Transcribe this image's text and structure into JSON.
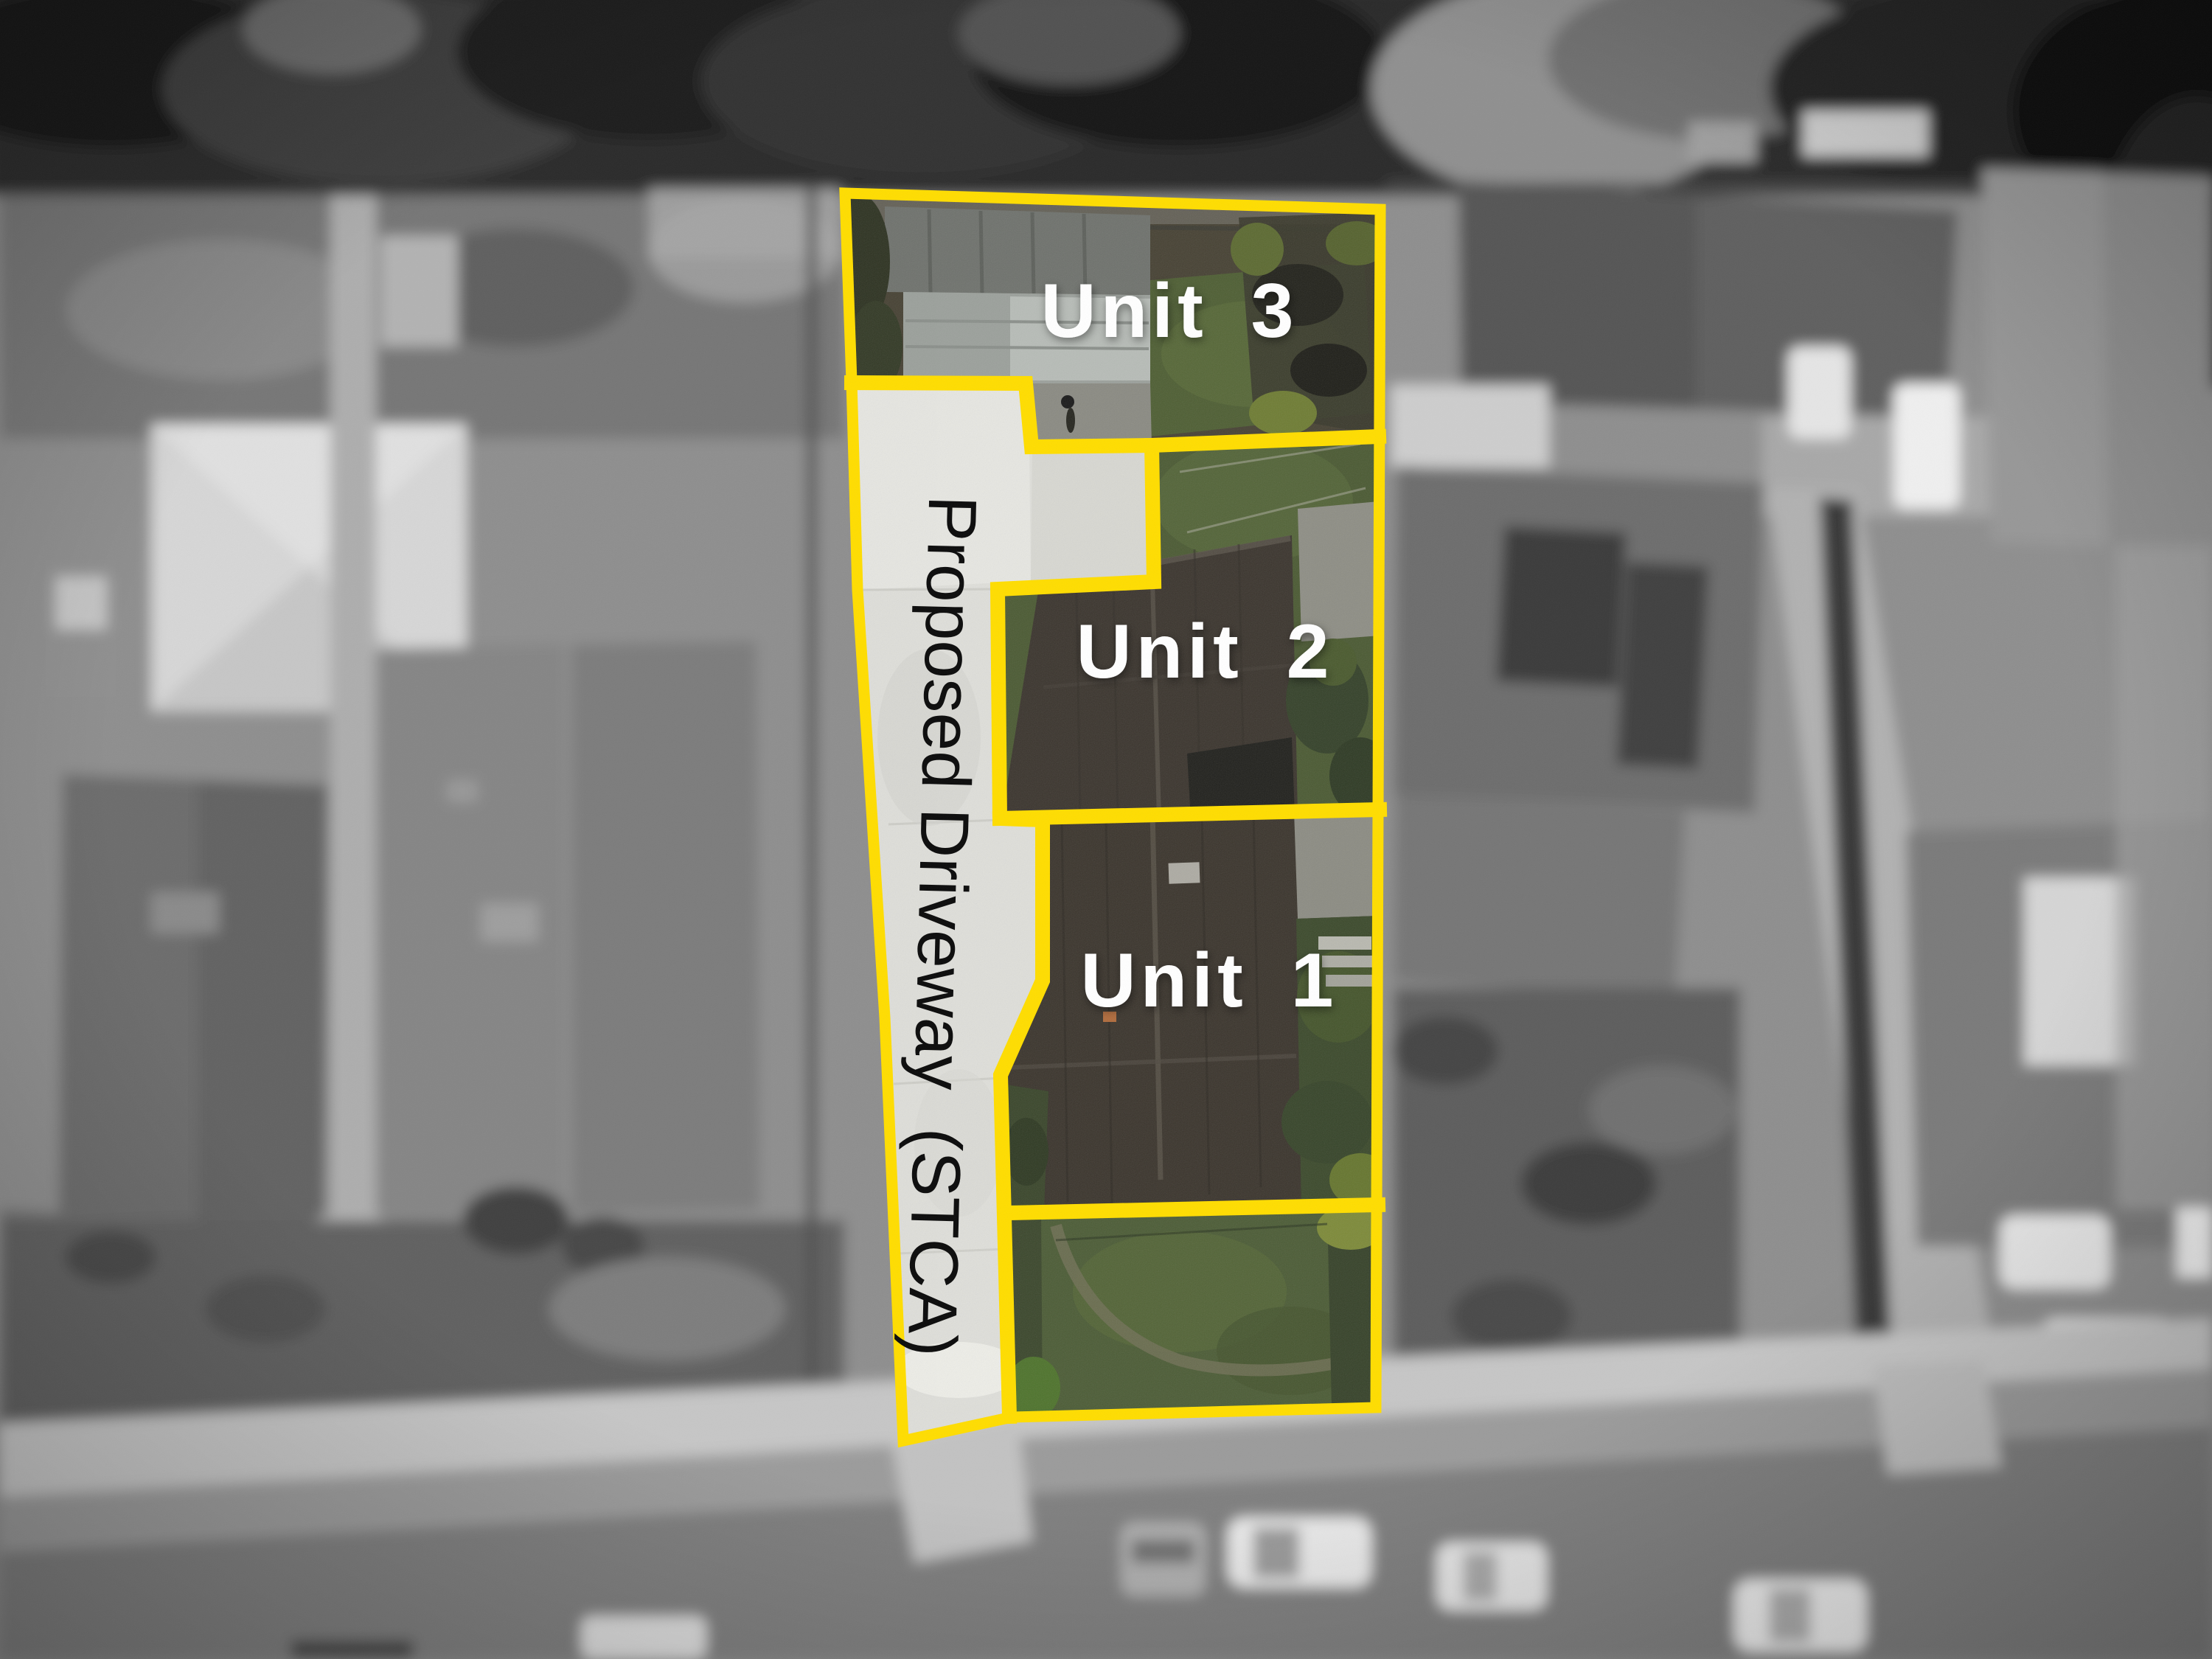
{
  "units": [
    {
      "label": "Unit 3"
    },
    {
      "label": "Unit 2"
    },
    {
      "label": "Unit 1"
    }
  ],
  "driveway": {
    "label": "Proposed Driveway  (STCA)"
  },
  "colors": {
    "boundary": "#ffdd00",
    "unit_label": "#ffffff",
    "driveway_label": "#0b0b0b"
  }
}
